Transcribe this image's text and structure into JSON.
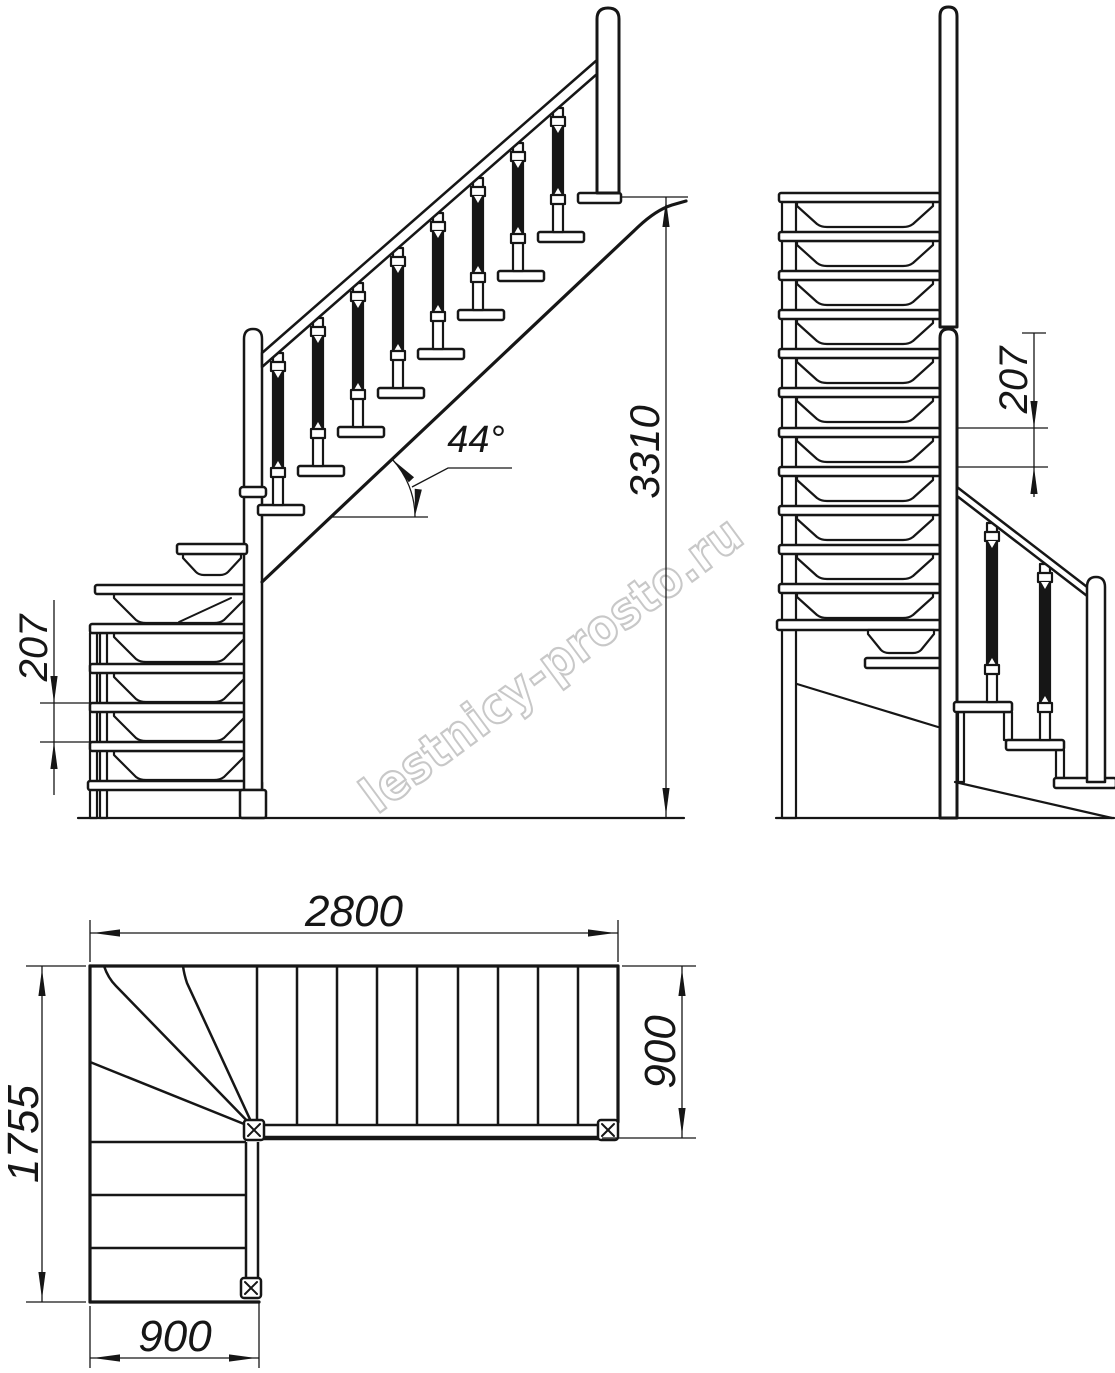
{
  "colors": {
    "line": "#161616",
    "watermark": "#c8c8c8",
    "background": "#ffffff"
  },
  "watermark": {
    "text": "lestnicy-prosto.ru"
  },
  "views": {
    "front_elevation": {
      "angle_label": "44°",
      "total_height_label": "3310",
      "riser_height_label": "207"
    },
    "side_elevation": {
      "riser_height_label": "207"
    },
    "plan": {
      "total_run_label": "2800",
      "upper_flight_width_label": "900",
      "total_depth_label": "1755",
      "lower_flight_width_label": "900"
    }
  }
}
